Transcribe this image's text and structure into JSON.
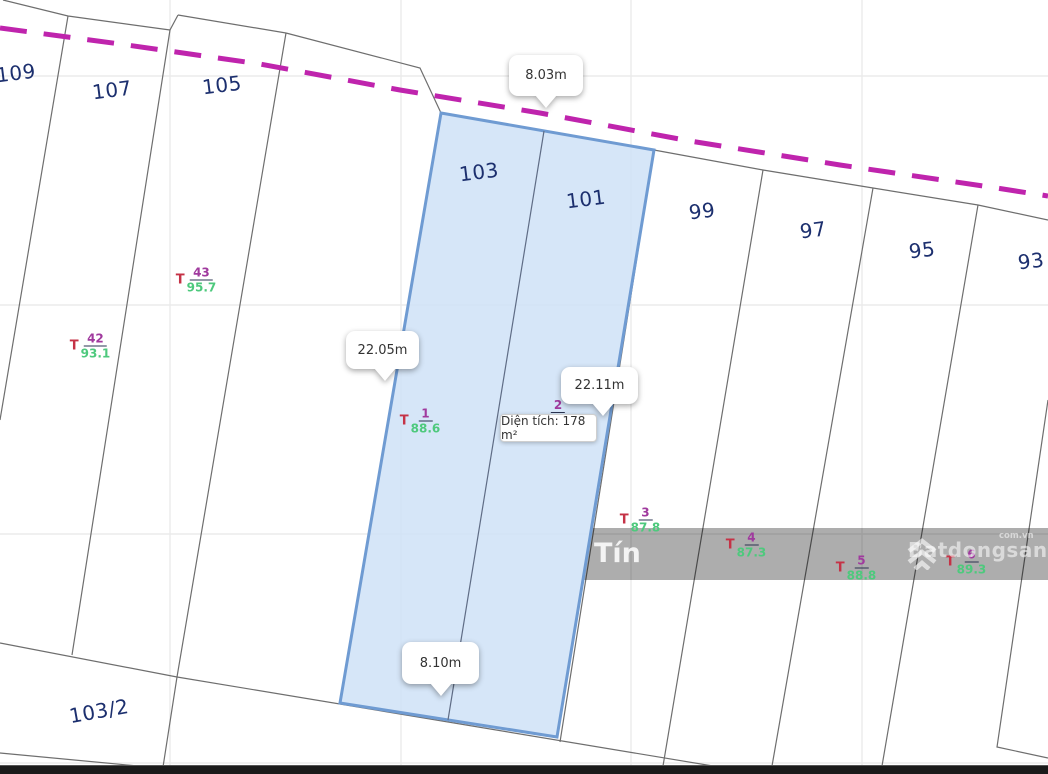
{
  "canvas": {
    "width": 1048,
    "height": 774
  },
  "colors": {
    "road_dash": "#bf24ad",
    "parcel_line": "#6e6e6e",
    "grid_line": "#ebebeb",
    "highlight_fill": "#cfe2f7",
    "highlight_stroke": "#6f9bd2",
    "plot_number": "#1c2f6e",
    "label_t": "#c53246",
    "label_numerator": "#a03a9e",
    "label_denominator": "#4ec97d",
    "watermark_band": "rgba(0,0,0,0.32)",
    "bottom_bar": "#1a1a1a"
  },
  "plots": [
    {
      "label": "109"
    },
    {
      "label": "107"
    },
    {
      "label": "105"
    },
    {
      "label": "103"
    },
    {
      "label": "101"
    },
    {
      "label": "99"
    },
    {
      "label": "97"
    },
    {
      "label": "95"
    },
    {
      "label": "93"
    },
    {
      "label": "103/2"
    }
  ],
  "measurements": [
    {
      "label": "8.03m"
    },
    {
      "label": "22.05m"
    },
    {
      "label": "22.11m"
    },
    {
      "label": "8.10m"
    }
  ],
  "area_tooltip": {
    "label": "Diện tích: 178 m²"
  },
  "survey_labels": [
    {
      "t": "T",
      "num": "43",
      "den": "95.7"
    },
    {
      "t": "T",
      "num": "42",
      "den": "93.1"
    },
    {
      "t": "T",
      "num": "1",
      "den": "88.6"
    },
    {
      "num": "2"
    },
    {
      "t": "T",
      "num": "3",
      "den": "87.8"
    },
    {
      "t": "T",
      "num": "4",
      "den": "87.3"
    },
    {
      "t": "T",
      "num": "5",
      "den": "88.8"
    },
    {
      "t": "T",
      "num": "6",
      "den": "89.3"
    }
  ],
  "watermarks": {
    "map_label": "Tín",
    "brand": "Batdongsan",
    "brand_suffix": "com.vn"
  }
}
